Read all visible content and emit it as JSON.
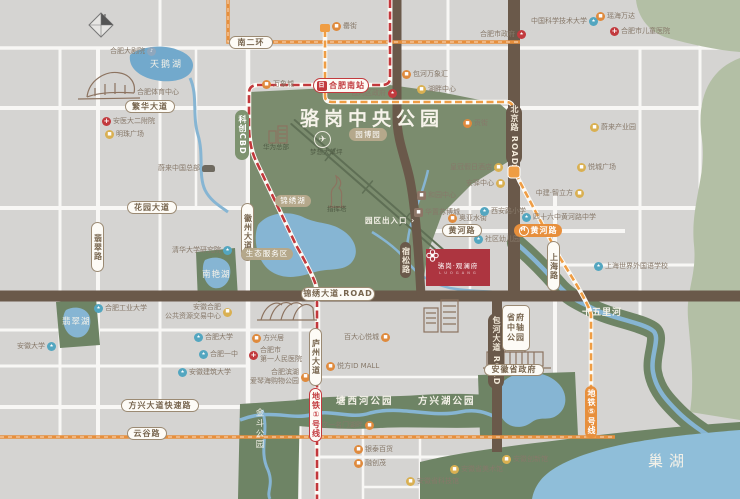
{
  "title": "骆岗中央公园",
  "compass": "N",
  "project": {
    "name": "骆岗·观澜府",
    "sub": "L U O G A N G"
  },
  "colors": {
    "park": "#7b8c6e",
    "water": "#86b5d3",
    "road_brown": "#6a594a",
    "metro1_red": "#c2383c",
    "metro_orange": "#e78f3c",
    "project_red": "#ad3540"
  },
  "map": {
    "road_pills": [
      {
        "label": "南二环",
        "x": 229,
        "y": 36,
        "w": 44,
        "h": 13
      },
      {
        "label": "繁华大道",
        "x": 125,
        "y": 100,
        "w": 50,
        "h": 13
      },
      {
        "label": "花园大道",
        "x": 127,
        "y": 201,
        "w": 50,
        "h": 13
      },
      {
        "label": "黄河路",
        "x": 442,
        "y": 224,
        "w": 40,
        "h": 13
      },
      {
        "label": "方兴大道快速路",
        "x": 121,
        "y": 399,
        "w": 78,
        "h": 13
      },
      {
        "label": "云谷路",
        "x": 127,
        "y": 427,
        "w": 40,
        "h": 13
      },
      {
        "label": "锦绣大道.ROAD",
        "x": 301,
        "y": 287,
        "w": 74,
        "h": 14
      },
      {
        "label": "翡翠路",
        "x": 91,
        "y": 222,
        "w": 13,
        "h": 50,
        "v": 1
      },
      {
        "label": "徽州大道",
        "x": 241,
        "y": 203,
        "w": 13,
        "h": 58,
        "v": 1
      },
      {
        "label": "庐州大道",
        "x": 309,
        "y": 328,
        "w": 13,
        "h": 58,
        "v": 1
      },
      {
        "label": "上海路",
        "x": 547,
        "y": 241,
        "w": 13,
        "h": 50,
        "v": 1
      },
      {
        "label": "北京路 ROAD",
        "x": 506,
        "y": 105,
        "w": 16,
        "h": 60,
        "v": 1,
        "s": "brown"
      },
      {
        "label": "包河大道 ROAD",
        "x": 488,
        "y": 313,
        "w": 16,
        "h": 76,
        "v": 1,
        "s": "brown"
      },
      {
        "label": "宿松路",
        "x": 400,
        "y": 242,
        "w": 11,
        "h": 36,
        "v": 1,
        "s": "brown"
      },
      {
        "label": "园博园",
        "x": 349,
        "y": 128,
        "w": 38,
        "h": 13,
        "s": "tan"
      },
      {
        "label": "锦绣湖",
        "x": 275,
        "y": 195,
        "w": 36,
        "h": 12,
        "s": "tan"
      },
      {
        "label": "生态服务区",
        "x": 241,
        "y": 248,
        "w": 52,
        "h": 12,
        "s": "tan"
      },
      {
        "label": "科创CBD",
        "x": 235,
        "y": 110,
        "w": 14,
        "h": 50,
        "v": 1,
        "s": "green"
      },
      {
        "label": "黄河路",
        "x": 514,
        "y": 224,
        "w": 48,
        "h": 13,
        "s": "orange",
        "metro": 1
      },
      {
        "label": "地铁⑤号线",
        "x": 585,
        "y": 386,
        "w": 12,
        "h": 52,
        "v": 1,
        "s": "orange"
      },
      {
        "label": "地铁①号线",
        "x": 309,
        "y": 388,
        "w": 13,
        "h": 54,
        "v": 1,
        "s": "metro1"
      },
      {
        "label": "省府\n中轴\n公园",
        "x": 502,
        "y": 305,
        "w": 28,
        "h": 46,
        "s": "gov3"
      },
      {
        "label": "安徽省政府",
        "x": 484,
        "y": 364,
        "w": 60,
        "h": 12
      },
      {
        "label": "合肥南站",
        "x": 313,
        "y": 78,
        "w": 56,
        "h": 15,
        "s": "station",
        "train": 1
      }
    ],
    "pois": [
      {
        "label": "中国科学技术大学",
        "x": 598,
        "y": 17,
        "type": "school",
        "align": "r"
      },
      {
        "label": "合肥市政府",
        "x": 526,
        "y": 30,
        "type": "gov",
        "align": "r"
      },
      {
        "label": "合肥大剧院",
        "x": 156,
        "y": 47,
        "type": "venue",
        "align": "r"
      },
      {
        "label": "万象城",
        "x": 262,
        "y": 80,
        "type": "mall"
      },
      {
        "label": "合肥体育中心",
        "x": 137,
        "y": 88,
        "type": "none"
      },
      {
        "label": "安医大二附院",
        "x": 102,
        "y": 117,
        "type": "hospital"
      },
      {
        "label": "明珠广场",
        "x": 105,
        "y": 130,
        "type": "biz"
      },
      {
        "label": "罍街",
        "x": 332,
        "y": 22,
        "type": "mall"
      },
      {
        "label": "包河区政府",
        "x": 397,
        "y": 89,
        "type": "gov",
        "align": "r"
      },
      {
        "label": "包河万象汇",
        "x": 402,
        "y": 70,
        "type": "mall"
      },
      {
        "label": "湖畔中心",
        "x": 417,
        "y": 85,
        "type": "biz"
      },
      {
        "label": "贡街",
        "x": 463,
        "y": 119,
        "type": "mall"
      },
      {
        "label": "瑶海万达",
        "x": 596,
        "y": 12,
        "type": "mall"
      },
      {
        "label": "合肥市儿童医院",
        "x": 610,
        "y": 27,
        "type": "hospital"
      },
      {
        "label": "蔚来产业园",
        "x": 590,
        "y": 123,
        "type": "biz"
      },
      {
        "label": "蔚来中国总部",
        "x": 215,
        "y": 164,
        "type": "car",
        "align": "r"
      },
      {
        "label": "清华大学研究院",
        "x": 232,
        "y": 246,
        "type": "school",
        "align": "r"
      },
      {
        "label": "合肥工业大学",
        "x": 94,
        "y": 304,
        "type": "school"
      },
      {
        "label": "安徽合肥\n公共资源交易中心",
        "x": 232,
        "y": 303,
        "type": "biz",
        "align": "r"
      },
      {
        "label": "合肥大学",
        "x": 194,
        "y": 333,
        "type": "school"
      },
      {
        "label": "合肥一中",
        "x": 199,
        "y": 350,
        "type": "school"
      },
      {
        "label": "安徽建筑大学",
        "x": 178,
        "y": 368,
        "type": "school"
      },
      {
        "label": "安徽大学",
        "x": 56,
        "y": 342,
        "type": "school",
        "align": "r"
      },
      {
        "label": "华为总部",
        "x": 263,
        "y": 143,
        "type": "parkdark"
      },
      {
        "label": "梦想大草坪",
        "x": 310,
        "y": 148,
        "type": "parkdark"
      },
      {
        "label": "指挥塔",
        "x": 327,
        "y": 205,
        "type": "parkdark"
      },
      {
        "label": "园区出入口 ›",
        "x": 365,
        "y": 216,
        "type": "parkwhite"
      },
      {
        "label": "皇冠假日酒店",
        "x": 503,
        "y": 163,
        "type": "biz",
        "align": "r"
      },
      {
        "label": "安驿中心",
        "x": 505,
        "y": 179,
        "type": "biz",
        "align": "r"
      },
      {
        "label": "和园中心",
        "x": 417,
        "y": 191,
        "type": "brown"
      },
      {
        "label": "华置苏博城",
        "x": 414,
        "y": 208,
        "type": "brown"
      },
      {
        "label": "奥亚水街",
        "x": 448,
        "y": 214,
        "type": "mall"
      },
      {
        "label": "西安路小学",
        "x": 480,
        "y": 207,
        "type": "school"
      },
      {
        "label": "社区幼儿园",
        "x": 474,
        "y": 235,
        "type": "school"
      },
      {
        "label": "四十六中黄河路中学",
        "x": 522,
        "y": 213,
        "type": "school"
      },
      {
        "label": "悦城广场",
        "x": 577,
        "y": 163,
        "type": "biz"
      },
      {
        "label": "中建·智立方",
        "x": 584,
        "y": 189,
        "type": "biz",
        "align": "r"
      },
      {
        "label": "上海世界外国语学校",
        "x": 594,
        "y": 262,
        "type": "school"
      },
      {
        "label": "方兴居",
        "x": 252,
        "y": 334,
        "type": "mall"
      },
      {
        "label": "合肥市\n第一人民医院",
        "x": 249,
        "y": 346,
        "type": "hospital"
      },
      {
        "label": "百大心悦城",
        "x": 390,
        "y": 333,
        "type": "mall",
        "align": "r"
      },
      {
        "label": "悦方ID MALL",
        "x": 326,
        "y": 362,
        "type": "mall"
      },
      {
        "label": "合肥滨湖\n爱琴海购物公园",
        "x": 310,
        "y": 368,
        "type": "mall",
        "align": "r"
      },
      {
        "label": "文一名门湖畔",
        "x": 374,
        "y": 421,
        "type": "mall",
        "align": "r"
      },
      {
        "label": "银泰百货",
        "x": 354,
        "y": 445,
        "type": "mall"
      },
      {
        "label": "融创茂",
        "x": 354,
        "y": 459,
        "type": "mall"
      },
      {
        "label": "安徽省科技馆",
        "x": 406,
        "y": 477,
        "type": "biz"
      },
      {
        "label": "安徽省美术馆",
        "x": 450,
        "y": 465,
        "type": "biz"
      },
      {
        "label": "安徽创新馆",
        "x": 502,
        "y": 455,
        "type": "biz"
      }
    ],
    "area_labels": [
      {
        "t": "天鹅湖",
        "x": 150,
        "y": 57,
        "fs": 9,
        "ls": 2
      },
      {
        "t": "南艳湖",
        "x": 202,
        "y": 268,
        "fs": 8.5,
        "ls": 1
      },
      {
        "t": "翡翠湖",
        "x": 62,
        "y": 315,
        "fs": 8.5,
        "ls": 1
      },
      {
        "t": "塘西河公园",
        "x": 336,
        "y": 393,
        "fs": 9.5,
        "ls": 2,
        "b": 1
      },
      {
        "t": "方兴湖公园",
        "x": 418,
        "y": 393,
        "fs": 9.5,
        "ls": 2,
        "b": 1
      },
      {
        "t": "金斗公园",
        "x": 253,
        "y": 408,
        "fs": 8.5,
        "ls": 2,
        "v": 1
      },
      {
        "t": "十五里河",
        "x": 582,
        "y": 305,
        "fs": 9,
        "ls": 1,
        "b": 1
      },
      {
        "t": "巢湖",
        "x": 648,
        "y": 450,
        "fs": 15,
        "ls": 6
      },
      {
        "t": "✈",
        "x": 314,
        "y": 131,
        "cls": "plane"
      }
    ]
  }
}
